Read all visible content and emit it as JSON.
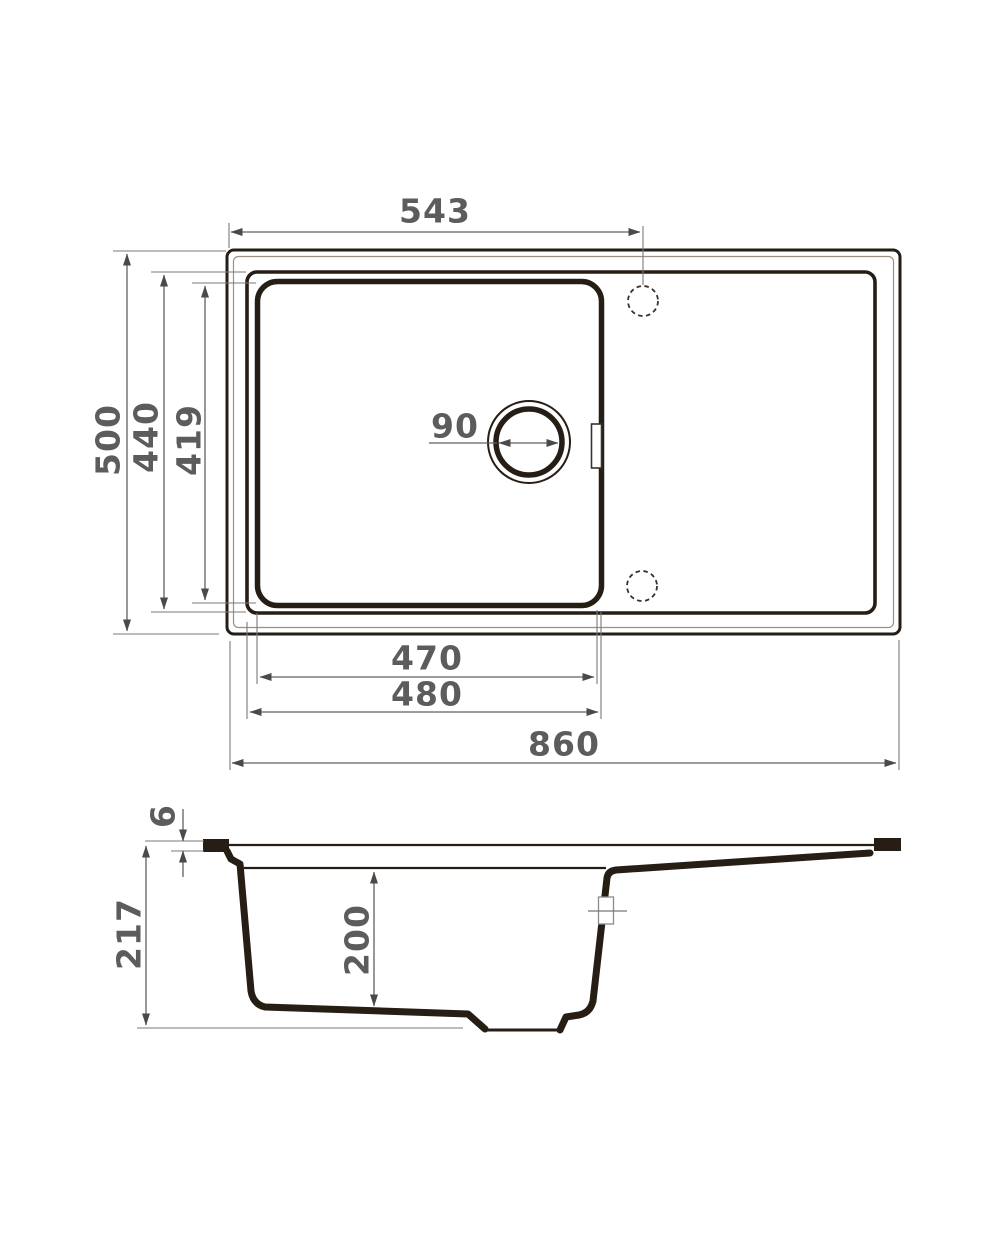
{
  "drawing": {
    "type": "kitchen-sink-technical-drawing",
    "views": {
      "top_view": "plan view of sink with bowl, drainboard, drain and faucet holes",
      "side_view": "cross-section profile of sink bowl"
    }
  },
  "dimensions_top_view": {
    "faucet_hole_offset": "543",
    "overall_depth": "500",
    "bowl_outer_depth": "440",
    "bowl_inner_depth": "419",
    "drain_diameter": "90",
    "bowl_inner_width": "470",
    "bowl_outer_width": "480",
    "overall_width": "860"
  },
  "dimensions_side_view": {
    "rim_thickness": "6",
    "overall_height": "217",
    "bowl_depth": "200"
  },
  "colors": {
    "object_line": "#261d15",
    "dimension_line": "#606060",
    "extension_line": "#7a7a7a",
    "arrow": "#4a4a4a",
    "label_text": "#5c5c5c",
    "background": "#ffffff"
  }
}
